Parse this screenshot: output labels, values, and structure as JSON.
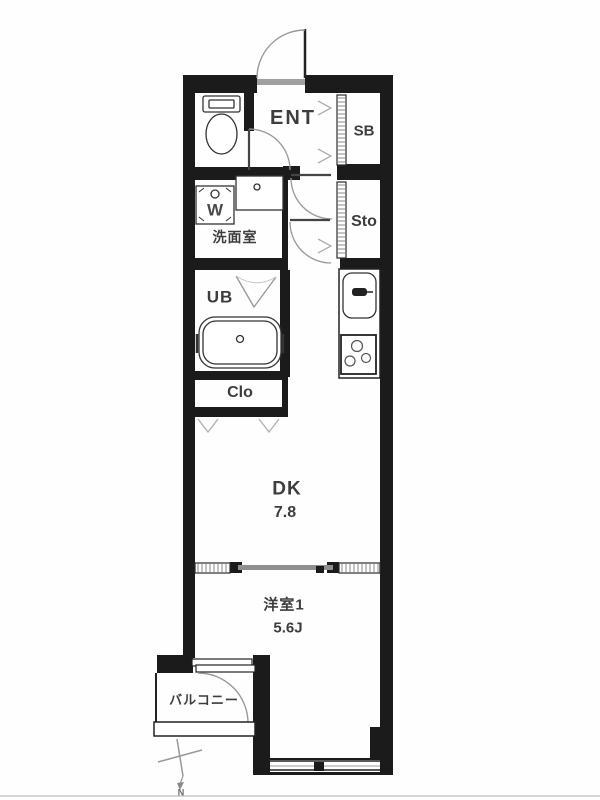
{
  "floorplan": {
    "rooms": {
      "entrance": {
        "label": "ENT"
      },
      "shoe_box": {
        "label": "SB"
      },
      "storage": {
        "label": "Sto"
      },
      "washroom": {
        "label": "洗面室"
      },
      "washer": {
        "label": "W"
      },
      "unit_bath": {
        "label": "UB"
      },
      "closet": {
        "label": "Clo"
      },
      "dining_kitchen": {
        "label": "DK",
        "size": "7.8"
      },
      "western_room": {
        "label": "洋室1",
        "size": "5.6J"
      },
      "balcony": {
        "label": "バルコニー"
      }
    },
    "compass": {
      "north_label": "N"
    },
    "colors": {
      "wall": "#1b1b1b",
      "fixture_line": "#333333",
      "door_arc": "#9a9a9a",
      "text": "#3d3d3d",
      "background": "#fefefe"
    }
  }
}
